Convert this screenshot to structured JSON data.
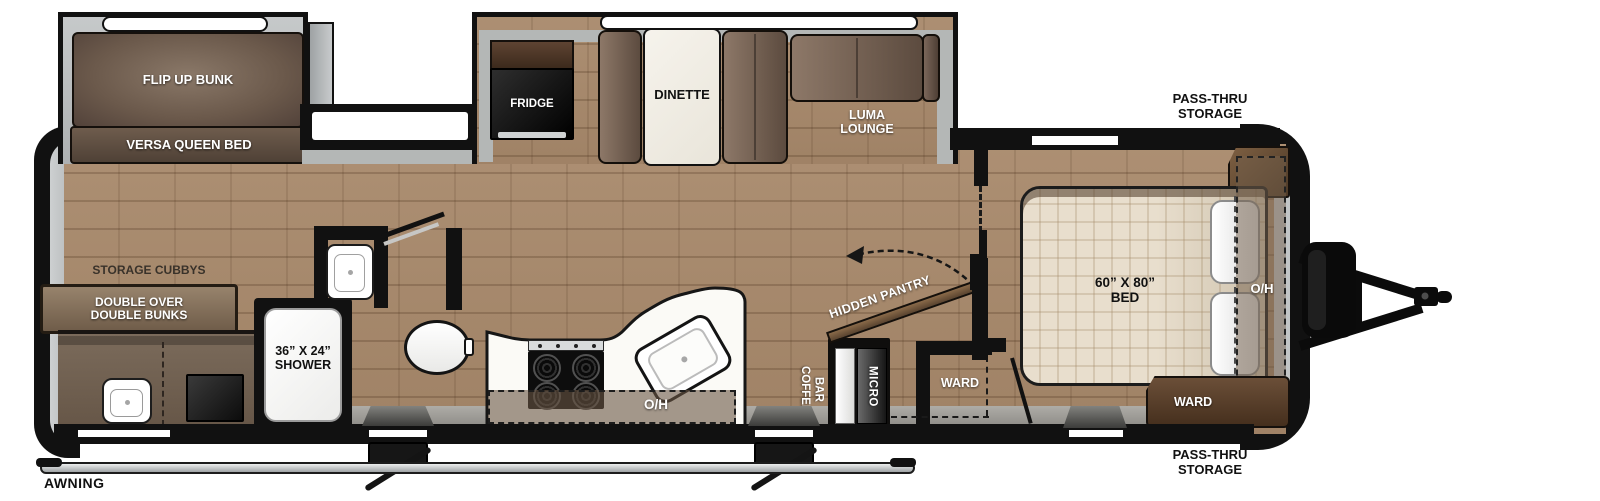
{
  "colors": {
    "wall": "#111111",
    "floor": "#a8896b",
    "slide_gray": "#b7bab9",
    "counter_white": "#fbfaf6",
    "sofa_brown": "#73604f",
    "cabinet_brown": "#5e4533",
    "awning_silver": "#cfd3d4",
    "bed_beige": "#ded3c1"
  },
  "exterior": {
    "awning": "AWNING",
    "pass_thru_line1": "PASS-THRU",
    "pass_thru_line2": "STORAGE"
  },
  "bunk_room": {
    "flip_up_bunk": "FLIP UP BUNK",
    "versa_queen_bed": "VERSA QUEEN BED",
    "storage_cubbys": "STORAGE CUBBYS",
    "double_bunks_line1": "DOUBLE OVER",
    "double_bunks_line2": "DOUBLE BUNKS"
  },
  "bathroom": {
    "shower_line1": "36” X 24”",
    "shower_line2": "SHOWER"
  },
  "kitchen": {
    "fridge": "FRIDGE",
    "dinette": "DINETTE",
    "luma_line1": "LUMA",
    "luma_line2": "LOUNGE",
    "overhead": "O/H",
    "coffee_line1": "COFFEE",
    "coffee_line2": "BAR",
    "micro": "MICRO",
    "hidden_pantry": "HIDDEN PANTRY"
  },
  "hall": {
    "ward": "WARD"
  },
  "bedroom": {
    "bed_line1": "60” X 80”",
    "bed_line2": "BED",
    "overhead": "O/H",
    "ward": "WARD"
  }
}
